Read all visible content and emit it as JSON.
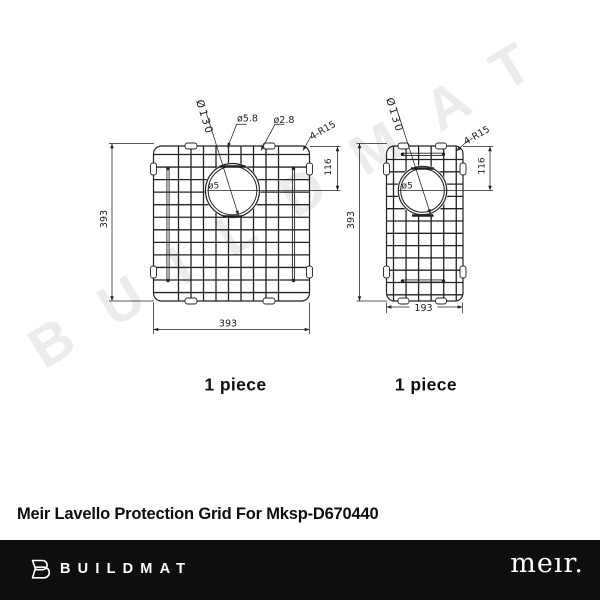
{
  "watermark": {
    "text": "BUILDMAT",
    "color": "#ececec"
  },
  "diagram": {
    "left": {
      "hole_diameter": "Ø130",
      "frame_wire_diameter": "ø5.8",
      "cross_wire_diameter": "ø2.8",
      "corner_radius": "4-R15",
      "hole_offset": "116",
      "height": "393",
      "width": "393",
      "wire_diameter": "ø5",
      "quantity": "1 piece"
    },
    "right": {
      "hole_diameter": "Ø130",
      "corner_radius": "4-R15",
      "hole_offset": "116",
      "height": "393",
      "width": "193",
      "wire_diameter": "ø5",
      "quantity": "1 piece"
    }
  },
  "title": "Meir Lavello Protection Grid For Mksp-D670440",
  "footer": {
    "brand": "BUILDMAT",
    "partner_logo": "meır.",
    "background": "#0e0e0e"
  },
  "colors": {
    "line": "#222222",
    "background": "#ffffff"
  }
}
